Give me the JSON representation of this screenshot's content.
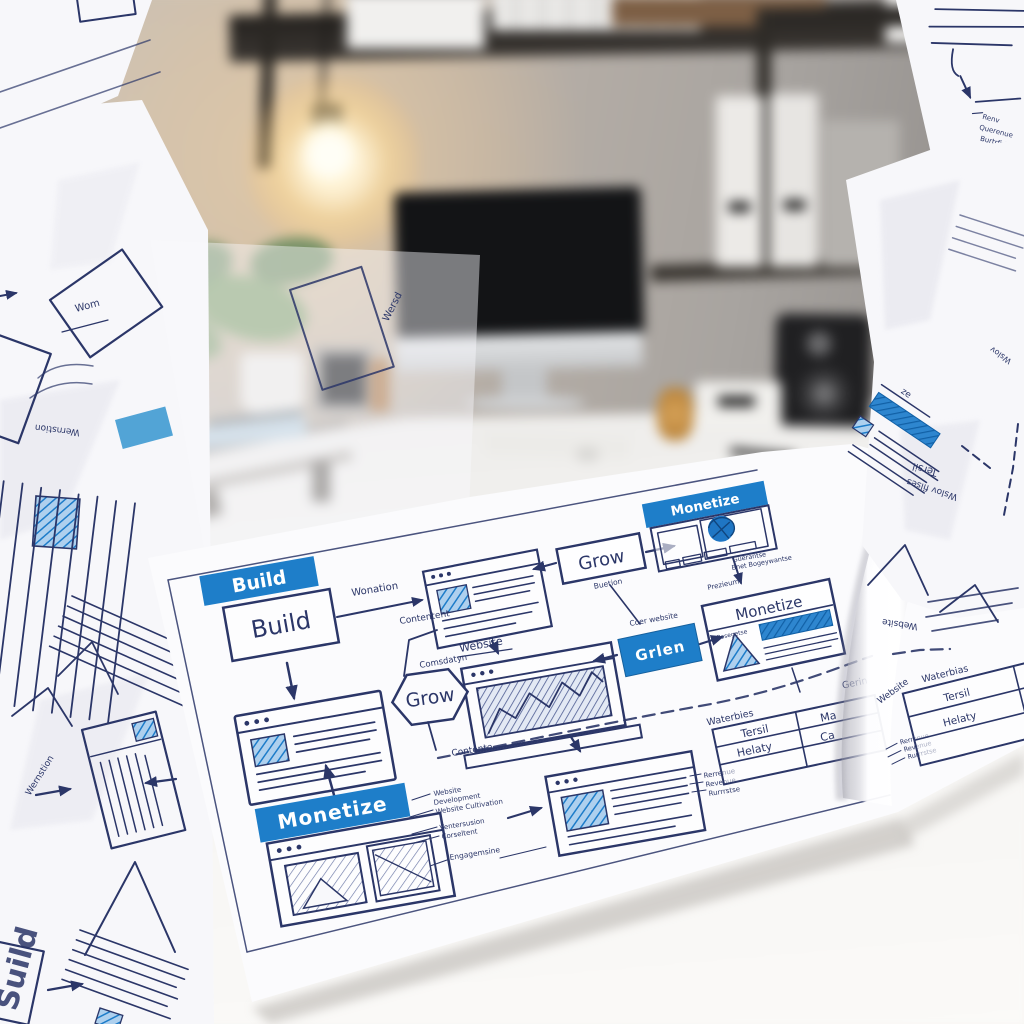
{
  "scene": {
    "description": "Bright home-office desk photo: blurred monitor, warm lamp, shelves and plant behind a large hand-drawn website flowchart poster surrounded by crumpled wireframe sketch papers",
    "colors": {
      "accent_blue": "#1e7ec9",
      "ink_navy": "#2b3668",
      "paper_white": "#f8f8fb",
      "wall_warm": "#c8bcae",
      "wall_cool": "#9b9794",
      "desk_white": "#f3f2f0",
      "shelf_dark": "#2e2b27",
      "lamp_glow": "#ffe9b8"
    }
  },
  "poster": {
    "build_banner": "Build",
    "build_box": "Build",
    "wonation": "Wonation",
    "contentent": "Contentent",
    "comsdatyn": "Comsdatyn",
    "contente": "Contente",
    "grow_hex": "Grow",
    "grow_box": "Grow",
    "buetion": "Buetion",
    "website_top": "Website",
    "monetize_card": "Monetize",
    "guerantse": "Guerantse",
    "bnet": "Bnet Bogeywantse",
    "prezieum": "Prezieum",
    "monetize_box": "Monetize",
    "rosegetse": "Rosegetse",
    "grlen": "Grlen",
    "coer_website": "Coer website",
    "monetize_banner": "Monetize",
    "annotations": [
      "Website",
      "Development",
      "Website Cultivation",
      "Ventersusion",
      "Corseltent",
      "Engagemsine"
    ],
    "revenue": [
      "Rerrenue",
      "Revenue",
      "Rurrrstse"
    ],
    "table_left": {
      "caption": "Waterbies",
      "caption_right": "Gerin",
      "r1c1": "Tersil",
      "r1c2": "Ma",
      "r2c1": "Helaty",
      "r2c2": "Ca"
    },
    "table_right": {
      "caption": "Waterbias",
      "r1": "Tersil",
      "r2": "Helaty"
    },
    "fold_website_top": "Website",
    "fold_website_side": "Website"
  },
  "scraps": {
    "wom": "Wom",
    "wersd": "Wersd",
    "wernstion_a": "Wernstion",
    "wernstion_b": "Wernstion",
    "suild": "Suild",
    "ze": "ze",
    "tersil": "Tersil",
    "wslov_filses": "Wslov filses",
    "wslov": "Wslov",
    "renv": "Renv",
    "querenue": "Querenue",
    "burtrfirt": "Burtrfirt"
  }
}
